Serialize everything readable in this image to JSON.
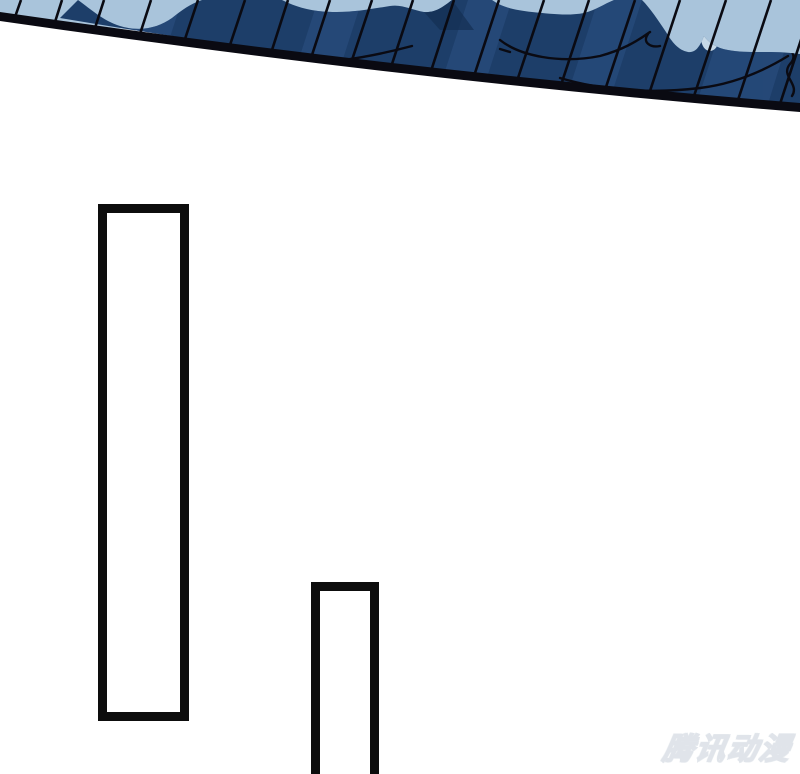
{
  "meta": {
    "width": 800,
    "height": 774
  },
  "artwork": {
    "description": "Manhua panel: dark navy tiled roof eave seen from below against a pale blue sky, thick black eave edge running diagonally, empty white space beneath with two empty vertical caption frames",
    "colors": {
      "background": "#ffffff",
      "sky": "#a9c4db",
      "sky_light": "#c6d9e8",
      "roof": "#1d3e69",
      "roof_light": "#30548a",
      "roof_dark": "#142f52",
      "ink": "#0a0a12",
      "frame_border": "#0d0d0d"
    },
    "caption_frames": [
      {
        "text": ""
      },
      {
        "text": ""
      }
    ]
  },
  "watermark": {
    "label": "腾讯动漫"
  }
}
